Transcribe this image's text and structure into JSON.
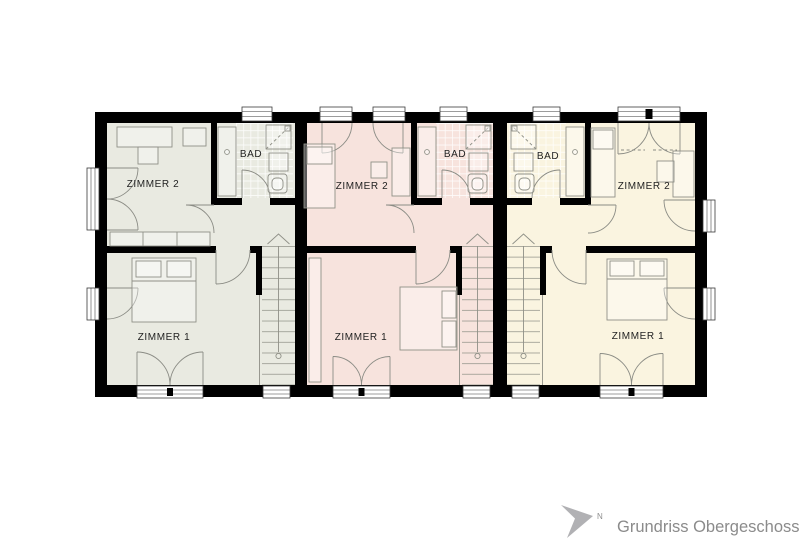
{
  "plan": {
    "caption": "Grundriss Obergeschoss",
    "north_label": "N",
    "units": [
      {
        "name": "unit-left",
        "fill": "#e9eae1",
        "labels": {
          "zimmer1": "ZIMMER 1",
          "zimmer2": "ZIMMER 2",
          "bad": "BAD"
        }
      },
      {
        "name": "unit-middle",
        "fill": "#f7e3dd",
        "labels": {
          "zimmer1": "ZIMMER 1",
          "zimmer2": "ZIMMER 2",
          "bad": "BAD"
        }
      },
      {
        "name": "unit-right",
        "fill": "#faf4e0",
        "labels": {
          "zimmer1": "ZIMMER 1",
          "zimmer2": "ZIMMER 2",
          "bad": "BAD"
        }
      }
    ],
    "palette": {
      "wall": "#000000",
      "furniture_stroke": "#8f9087",
      "label_text": "#222222",
      "caption_text": "#8b8b8b",
      "north_arrow": "#b1b1b4"
    }
  }
}
